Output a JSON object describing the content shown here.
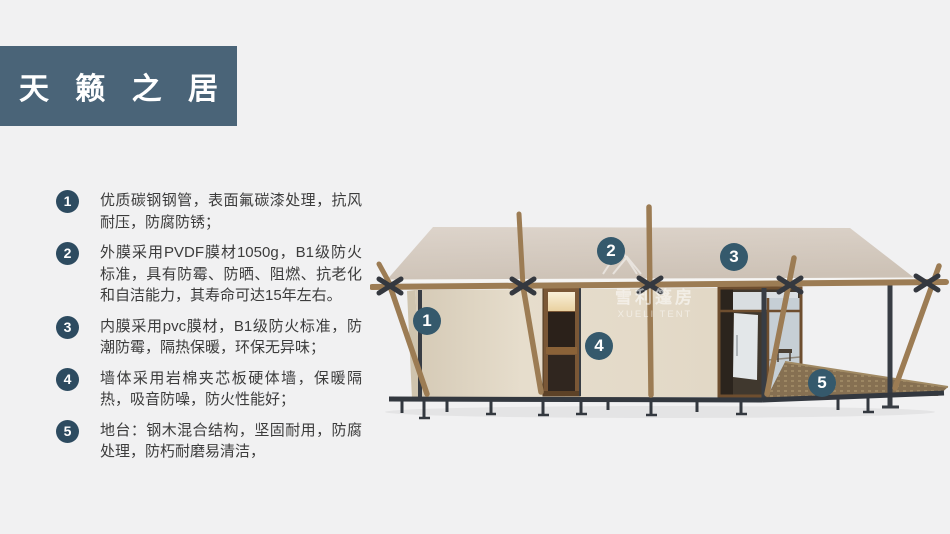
{
  "header": {
    "title": "天 籁 之 居",
    "box_color": "#4a6478",
    "text_color": "#ffffff"
  },
  "features": [
    {
      "num": "1",
      "text": "优质碳钢钢管，表面氟碳漆处理，抗风耐压，防腐防锈；"
    },
    {
      "num": "2",
      "text": "外膜采用PVDF膜材1050g，B1级防火标准，具有防霉、防晒、阻燃、抗老化和自洁能力，其寿命可达15年左右。"
    },
    {
      "num": "3",
      "text": "内膜采用pvc膜材，B1级防火标准，防潮防霉，隔热保暖，环保无异味；"
    },
    {
      "num": "4",
      "text": "墙体采用岩棉夹芯板硬体墙，保暖隔热，吸音防噪，防火性能好；"
    },
    {
      "num": "5",
      "text": "地台：钢木混合结构，坚固耐用，防腐处理，防朽耐磨易清洁，"
    }
  ],
  "diagram": {
    "markers": [
      {
        "num": "1"
      },
      {
        "num": "2"
      },
      {
        "num": "3"
      },
      {
        "num": "4"
      },
      {
        "num": "5"
      }
    ],
    "watermark": {
      "cn": "雪利篷房",
      "en": "XUELI TENT"
    },
    "colors": {
      "page_background": "#f1f1f2",
      "badge": "#2d4b60",
      "marker": "#35596c",
      "roof": "#d5cac0",
      "wall": "#e3dac9",
      "wood": "#9c7c54",
      "steel": "#383d44",
      "deck": "#867052"
    }
  }
}
